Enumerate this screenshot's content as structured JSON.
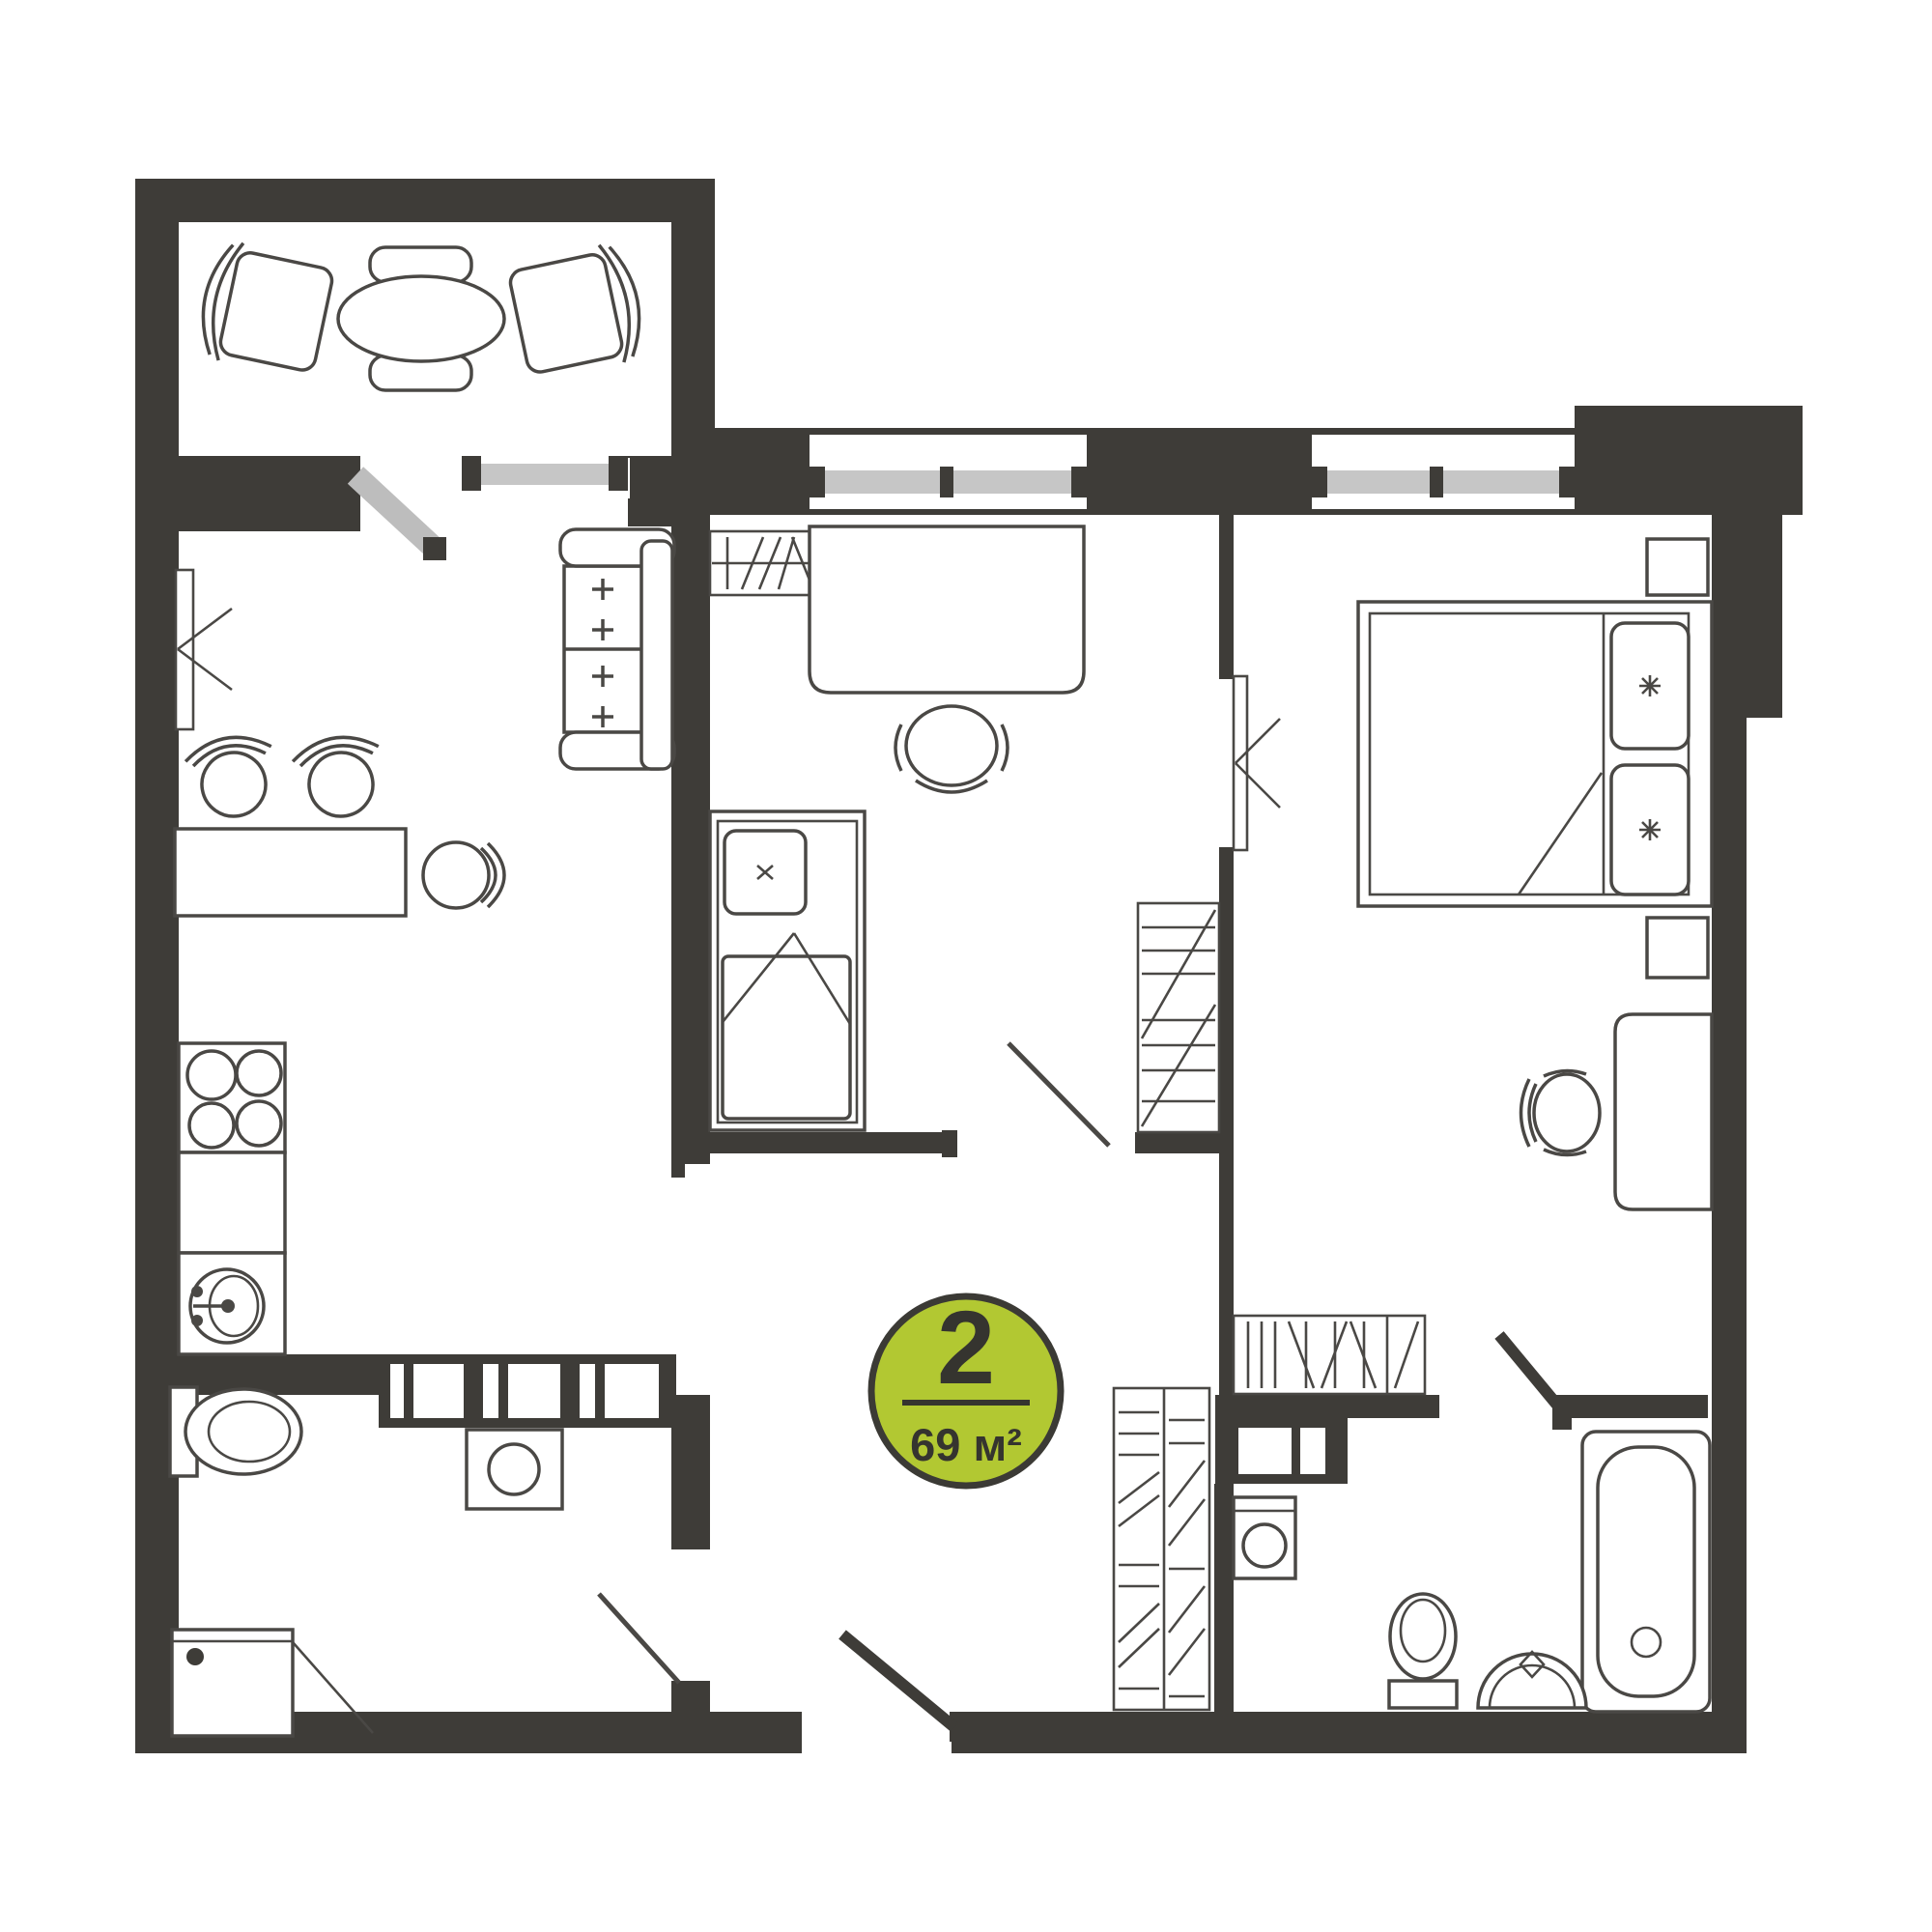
{
  "page": {
    "background": "#ffffff",
    "kind": "apartment-floor-plan"
  },
  "plan": {
    "badge": {
      "rooms_count": "2",
      "area_label": "69 м²",
      "bg_color": "#b2c832",
      "border_color": "#3b3a35",
      "text_color": "#35342f"
    },
    "colors": {
      "wall": "#3e3c38",
      "furniture_line": "#4a4845",
      "window_glass": "#c6c6c6",
      "door_leaf_gray": "#bdbdbd",
      "background": "#ffffff"
    },
    "rooms": [
      {
        "id": "balcony",
        "furniture": [
          "oval-dining-table",
          "chair-back-top",
          "chair-back-bottom",
          "armchair-left",
          "armchair-right"
        ]
      },
      {
        "id": "kitchen-living-room",
        "furniture": [
          "coat-rack",
          "sofa",
          "bar-stool",
          "bar-stool",
          "kitchen-table",
          "round-chair",
          "stove",
          "kitchen-counter",
          "kitchen-sink"
        ]
      },
      {
        "id": "bedroom-middle",
        "furniture": [
          "desk",
          "office-chair",
          "single-bed",
          "pillow",
          "wardrobe",
          "shelf"
        ]
      },
      {
        "id": "bedroom-right",
        "furniture": [
          "double-bed",
          "pillow",
          "pillow",
          "nightstand",
          "nightstand",
          "chair",
          "dresser",
          "wardrobe"
        ]
      },
      {
        "id": "wc",
        "furniture": [
          "toilet",
          "slotted-cabinet",
          "washing-machine",
          "shower-cabin"
        ]
      },
      {
        "id": "bathroom",
        "furniture": [
          "bathtub",
          "toilet",
          "wash-basin",
          "washing-machine",
          "duct-shaft"
        ]
      },
      {
        "id": "hallway",
        "furniture": [
          "wardrobe"
        ]
      }
    ],
    "openings": {
      "windows": 3,
      "entry_doors": 1,
      "interior_doors": 5,
      "balcony_doors": 1
    }
  }
}
